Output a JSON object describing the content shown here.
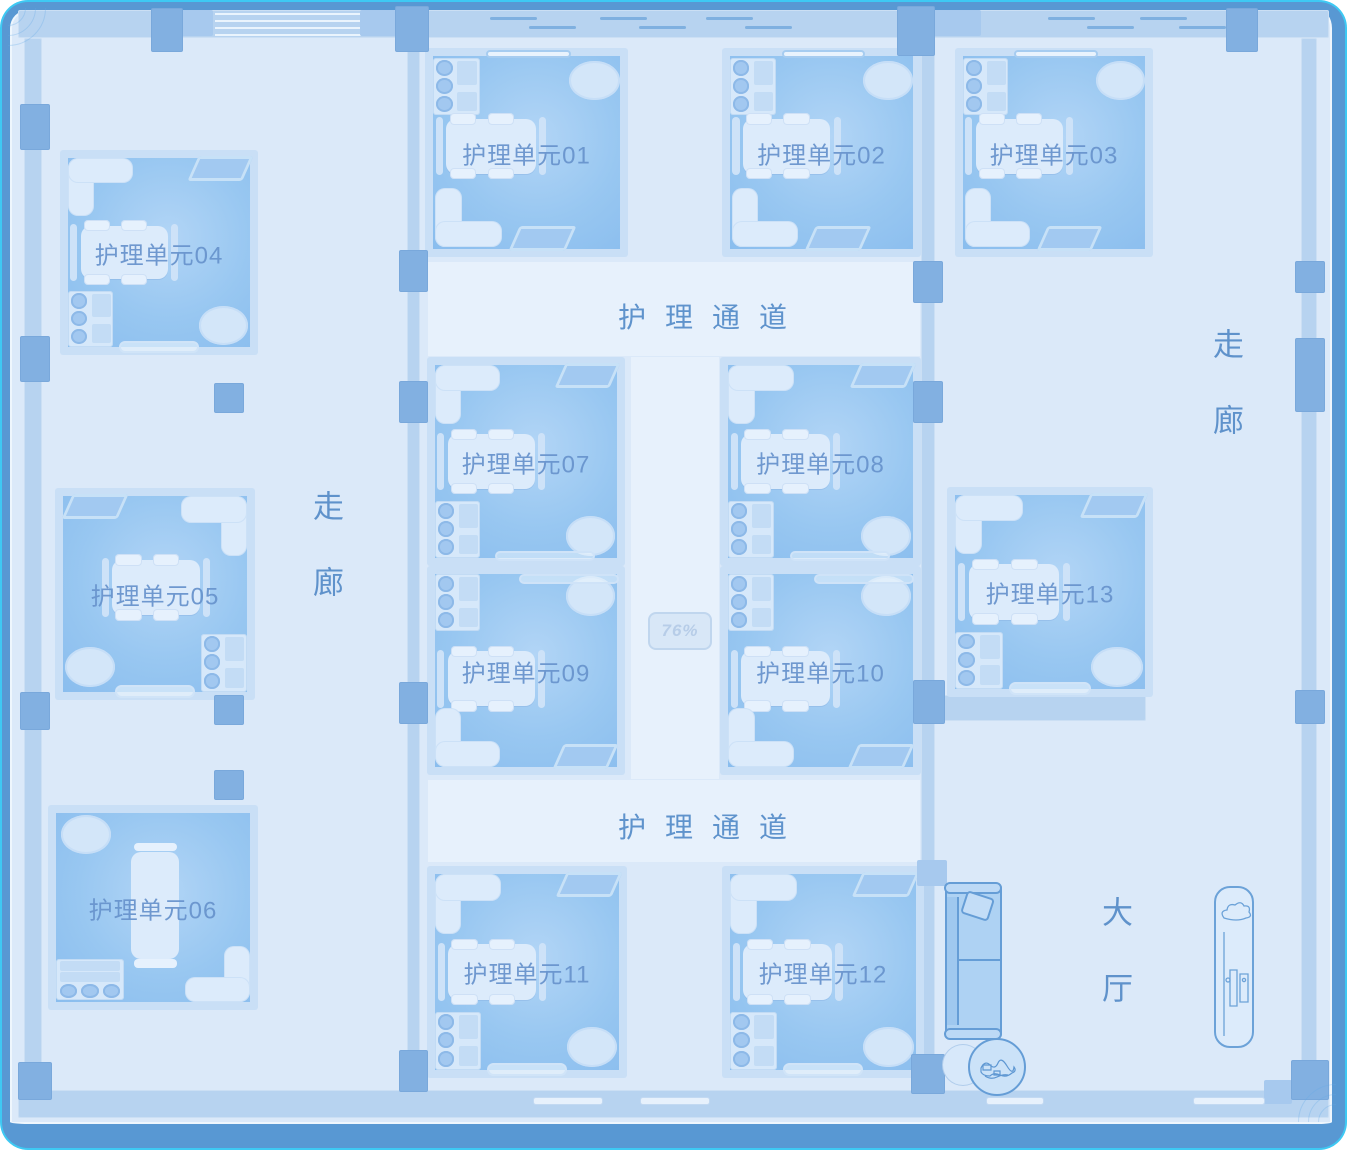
{
  "app": {
    "name": "nursing-floor-plan"
  },
  "labels": {
    "corridor_top": "护理通道",
    "corridor_bottom": "护理通道",
    "corridor_left": "走廊",
    "corridor_right": "走廊",
    "hall": "大厅",
    "badge": "76%"
  },
  "colors": {
    "floor": "#dbe9f9",
    "room_fill": "#8fc1ef",
    "room_band": "#c9dff6",
    "wall": "#b7d3f0",
    "column": "#82b0e1",
    "frame": "#5898d3",
    "frame_glow": "#3ec9f3",
    "room_label_text": "#6894cc",
    "corridor_text": "#5f93cc"
  },
  "rooms": [
    {
      "id": "01",
      "label": "护理单元01",
      "x": 425,
      "y": 48,
      "w": 203,
      "h": 209,
      "variant": "a",
      "door": false
    },
    {
      "id": "02",
      "label": "护理单元02",
      "x": 722,
      "y": 48,
      "w": 199,
      "h": 209,
      "variant": "a",
      "door": false
    },
    {
      "id": "03",
      "label": "护理单元03",
      "x": 955,
      "y": 48,
      "w": 198,
      "h": 209,
      "variant": "a",
      "door": false
    },
    {
      "id": "04",
      "label": "护理单元04",
      "x": 60,
      "y": 150,
      "w": 198,
      "h": 205,
      "variant": "c",
      "door": true
    },
    {
      "id": "05",
      "label": "护理单元05",
      "x": 55,
      "y": 488,
      "w": 200,
      "h": 212,
      "variant": "b",
      "door": true
    },
    {
      "id": "06",
      "label": "护理单元06",
      "x": 48,
      "y": 805,
      "w": 210,
      "h": 205,
      "variant": "d",
      "door": false
    },
    {
      "id": "07",
      "label": "护理单元07",
      "x": 427,
      "y": 357,
      "w": 198,
      "h": 209,
      "variant": "c",
      "door": false
    },
    {
      "id": "08",
      "label": "护理单元08",
      "x": 720,
      "y": 357,
      "w": 201,
      "h": 209,
      "variant": "c",
      "door": false
    },
    {
      "id": "09",
      "label": "护理单元09",
      "x": 427,
      "y": 566,
      "w": 198,
      "h": 209,
      "variant": "e",
      "door": false
    },
    {
      "id": "10",
      "label": "护理单元10",
      "x": 720,
      "y": 566,
      "w": 201,
      "h": 209,
      "variant": "e",
      "door": false
    },
    {
      "id": "11",
      "label": "护理单元11",
      "x": 427,
      "y": 866,
      "w": 200,
      "h": 212,
      "variant": "c",
      "door": true
    },
    {
      "id": "12",
      "label": "护理单元12",
      "x": 722,
      "y": 866,
      "w": 202,
      "h": 212,
      "variant": "c",
      "door": true
    },
    {
      "id": "13",
      "label": "护理单元13",
      "x": 947,
      "y": 487,
      "w": 206,
      "h": 210,
      "variant": "c",
      "door": true
    }
  ]
}
